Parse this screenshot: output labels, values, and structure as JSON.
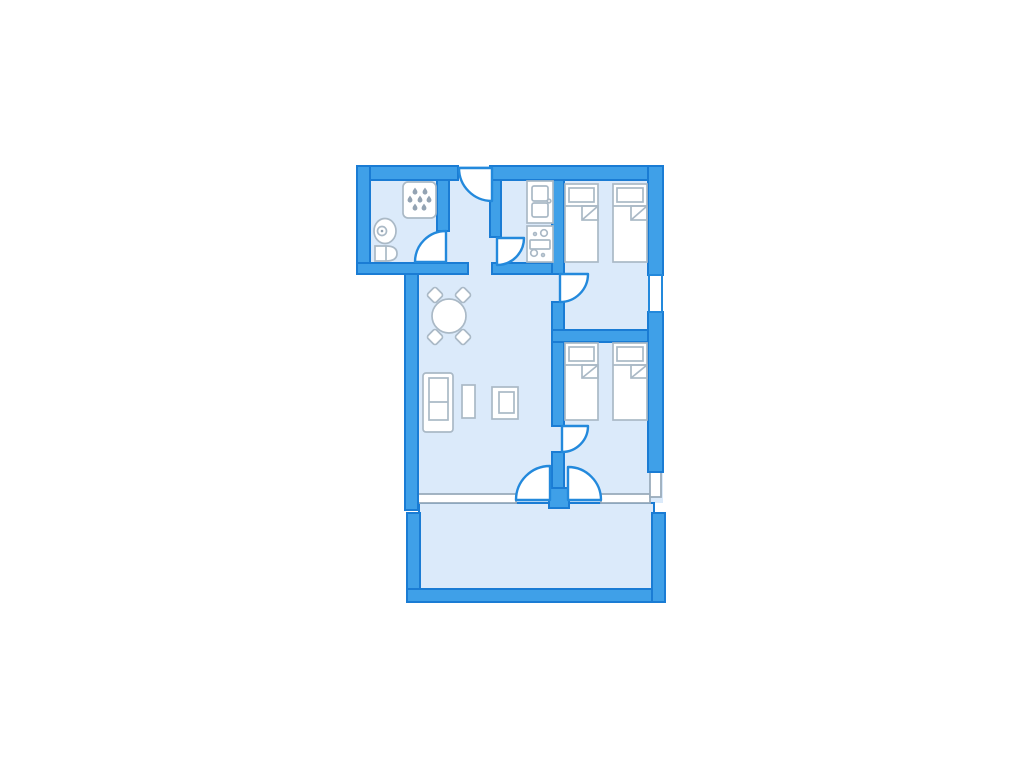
{
  "palette": {
    "page_bg": "#ffffff",
    "wall_fill": "#3fa0e8",
    "wall_stroke": "#1a7cd4",
    "room_fill": "#dbeafa",
    "door_stroke": "#2389dc",
    "furn_stroke": "#aab9c6",
    "window_stroke": "#9aacbc",
    "drop_fill": "#93a3b3"
  },
  "plan": {
    "type": "apartment-floor-plan",
    "orientation": "top-down",
    "rooms": [
      {
        "name": "bathroom",
        "position": "top-left",
        "fixtures": [
          "shower",
          "washbasin",
          "toilet"
        ]
      },
      {
        "name": "hallway",
        "position": "top-center",
        "fixtures": []
      },
      {
        "name": "kitchen",
        "position": "top-center-right",
        "fixtures": [
          "sink-unit",
          "stove-oven-unit"
        ]
      },
      {
        "name": "bedroom-1",
        "position": "top-right",
        "fixtures": [
          "single-bed",
          "single-bed"
        ]
      },
      {
        "name": "bedroom-2",
        "position": "middle-right",
        "fixtures": [
          "single-bed",
          "single-bed"
        ]
      },
      {
        "name": "living-room",
        "position": "center-left",
        "fixtures": [
          "round-dining-table",
          "chair",
          "chair",
          "chair",
          "chair",
          "sofa",
          "coffee-table",
          "armchair"
        ]
      },
      {
        "name": "balcony",
        "position": "bottom",
        "fixtures": []
      }
    ],
    "doors": [
      {
        "name": "entry-door",
        "between": [
          "outside",
          "hallway"
        ],
        "swing": "quarter-arc"
      },
      {
        "name": "bathroom-door",
        "between": [
          "hallway",
          "bathroom"
        ],
        "swing": "quarter-arc"
      },
      {
        "name": "kitchen-door",
        "between": [
          "hallway",
          "kitchen"
        ],
        "swing": "quarter-arc"
      },
      {
        "name": "bedroom-1-door",
        "between": [
          "living-room",
          "bedroom-1"
        ],
        "swing": "quarter-arc"
      },
      {
        "name": "bedroom-2-door",
        "between": [
          "living-room",
          "bedroom-2"
        ],
        "swing": "quarter-arc"
      },
      {
        "name": "balcony-door-left",
        "between": [
          "living-room",
          "balcony"
        ],
        "swing": "quarter-arc"
      },
      {
        "name": "balcony-door-right",
        "between": [
          "bedroom-2",
          "balcony"
        ],
        "swing": "quarter-arc"
      }
    ],
    "windows": [
      {
        "name": "window-right-bedroom-1",
        "wall": "right"
      },
      {
        "name": "window-right-bedroom-2-corner",
        "wall": "right-bottom-corner"
      },
      {
        "name": "window-bottom-living-room",
        "wall": "bottom"
      },
      {
        "name": "window-bottom-bedroom-2",
        "wall": "bottom"
      }
    ]
  }
}
